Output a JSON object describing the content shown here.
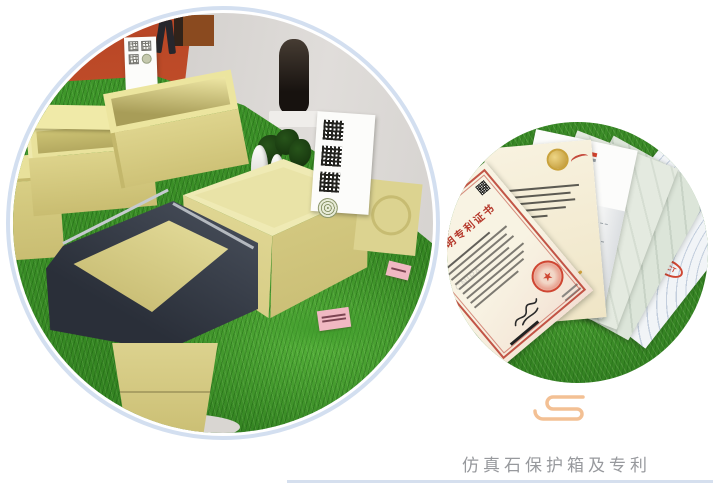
{
  "caption": {
    "text": "仿真石保护箱及专利"
  },
  "right_photo": {
    "patent_certificate_title": "发明专利证书",
    "watermark_text": "CNIPA",
    "pct_stamp_text": "PCT"
  },
  "colors": {
    "ring": "#d3dff0",
    "caption": "#97999d",
    "underline": "#d5dfee",
    "cloud": "#f3c094",
    "grass-dark": "#2f7c1e",
    "grass-mid": "#3f982a",
    "grass-bright": "#55b13a",
    "box-beige": "#dcd28c",
    "box-beige-light": "#efeab4",
    "box-dark": "#353b47",
    "wall-orange": "#bf4c29",
    "wall-gray": "#d8d5d2",
    "cert-cream": "#f6f0df",
    "cert-red": "#b5372a",
    "seal-red": "#cf4632",
    "gold": "#c9a23c"
  }
}
